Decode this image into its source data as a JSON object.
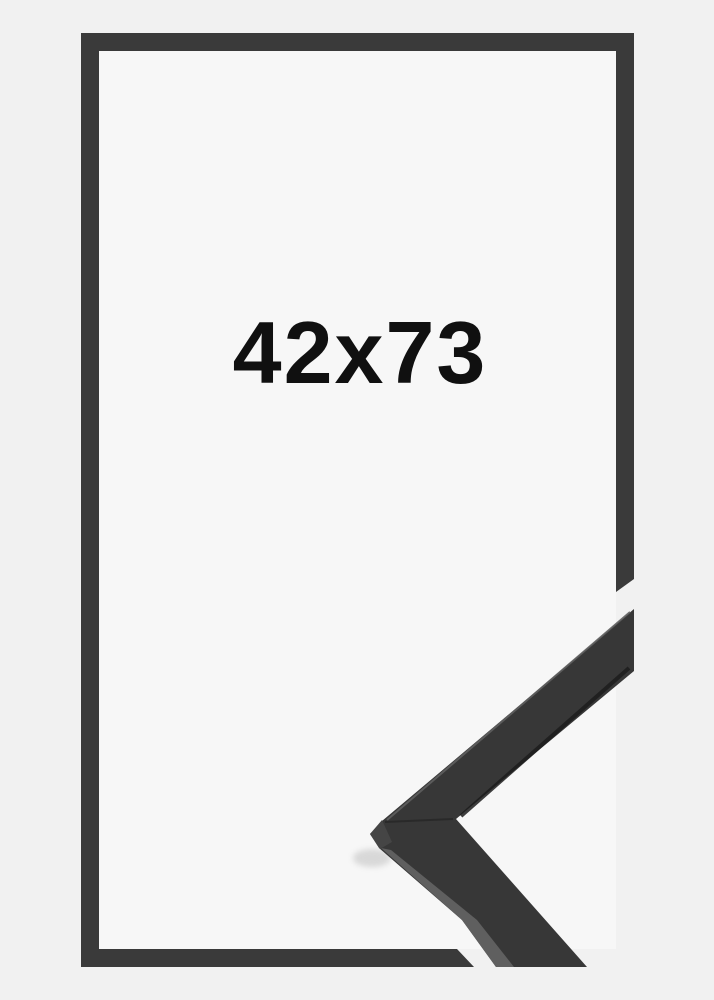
{
  "product": {
    "size_label": "42x73"
  },
  "colors": {
    "outer_bg": "#f1f1f1",
    "inner_bg": "#f7f7f7",
    "frame_outline": "#3a3a3a",
    "sample_front": "#373737",
    "sample_top": "#5f5f5f",
    "sample_end": "#454545",
    "sample_seam": "#262626",
    "sample_edge_dark": "#1d1d1d",
    "sample_edge_light": "#606060",
    "label_color": "#101010"
  }
}
